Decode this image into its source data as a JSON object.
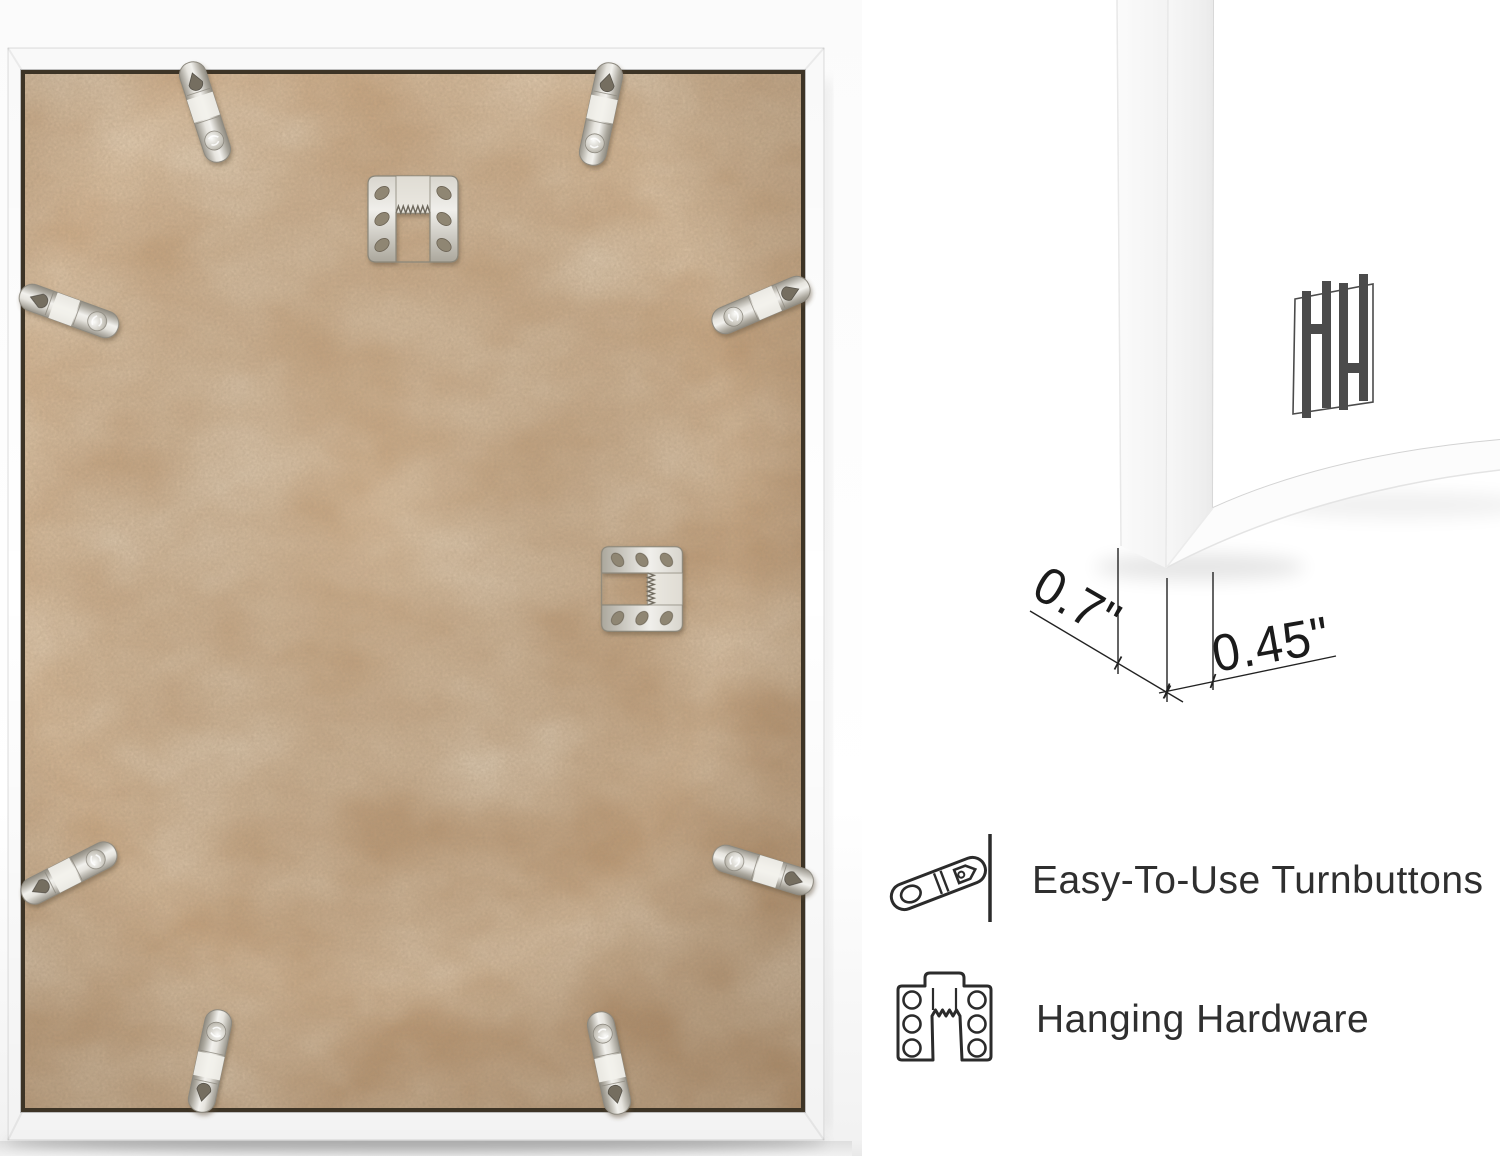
{
  "dimensions": {
    "depth": "0.7\"",
    "face_width": "0.45\""
  },
  "features": [
    {
      "icon": "turnbutton-icon",
      "label": "Easy-To-Use Turnbuttons"
    },
    {
      "icon": "hanging-hardware-icon",
      "label": "Hanging Hardware"
    }
  ],
  "frame_back": {
    "turnbutton_count": 8,
    "sawtooth_hanger_count": 2
  },
  "logo": {
    "monogram": "HH"
  },
  "colors": {
    "mdf_board": "#c4a17d",
    "frame": "#ffffff",
    "metal_hardware": "#cbc8c0",
    "annotation_ink": "#1c1c1c",
    "feature_text": "#2f2f2f",
    "logo_gray": "#4b4b4b"
  }
}
